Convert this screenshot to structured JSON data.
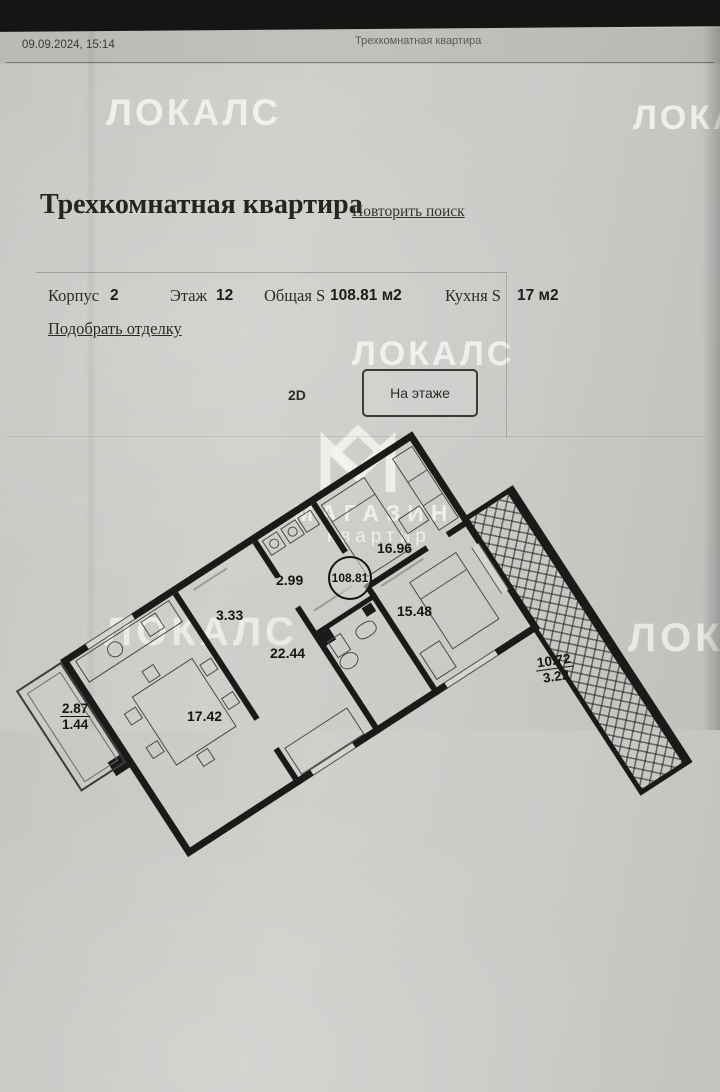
{
  "photo": {
    "timestamp": "09.09.2024, 15:14",
    "print_title": "Трехкомнатная квартира"
  },
  "watermark": {
    "brand": "ЛОКАЛС",
    "shop_line1": "МАГАЗИН",
    "shop_line2": "квартир"
  },
  "page": {
    "title": "Трехкомнатная квартира",
    "repeat_search": "Повторить поиск"
  },
  "details": {
    "fields": [
      {
        "label": "Корпус",
        "value": "2"
      },
      {
        "label": "Этаж",
        "value": "12"
      },
      {
        "label": "Общая S",
        "value": "108.81 м2"
      },
      {
        "label": "Кухня S",
        "value": "17 м2"
      }
    ],
    "finish_link": "Подобрать отделку"
  },
  "viewer": {
    "tab_2d": "2D",
    "floor_button": "На этаже"
  },
  "floorplan": {
    "total_area": "108.81",
    "rooms": [
      {
        "name": "bedroom-1",
        "area": "16.96"
      },
      {
        "name": "laundry",
        "area": "2.99"
      },
      {
        "name": "bathroom",
        "area": "3.33"
      },
      {
        "name": "bedroom-2",
        "area": "15.48"
      },
      {
        "name": "hallway",
        "area": "22.44"
      },
      {
        "name": "kitchen-living",
        "area": "17.42"
      }
    ],
    "balconies": [
      {
        "name": "balcony-small",
        "area": "2.87",
        "area_reduced": "1.44"
      },
      {
        "name": "loggia",
        "area": "10.72",
        "area_reduced": "3.22"
      }
    ]
  },
  "colors": {
    "paper": "#cccbc7",
    "ink": "#25241e",
    "wall": "#1a1a19",
    "watermark": "rgba(248,247,244,0.82)"
  }
}
